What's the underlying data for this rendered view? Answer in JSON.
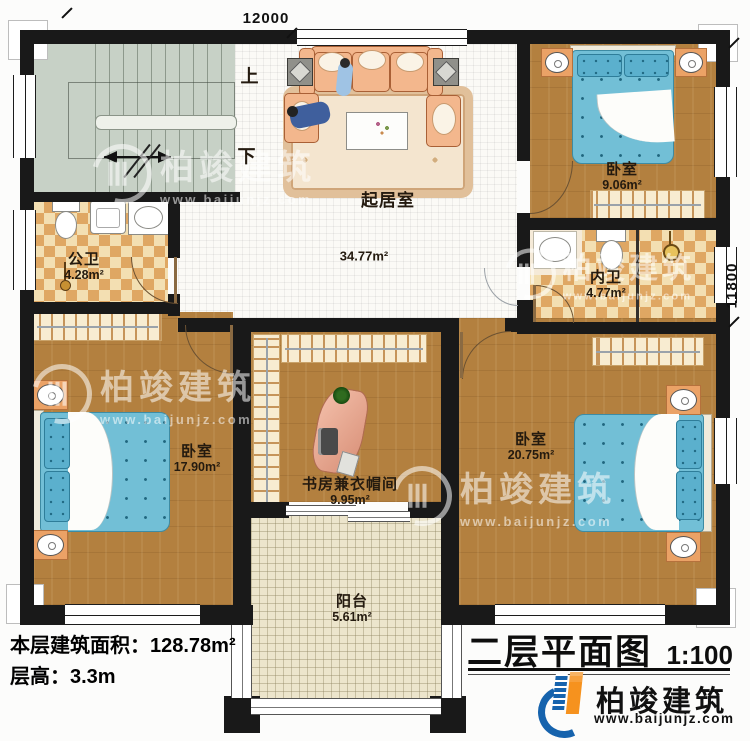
{
  "meta": {
    "dim_top": "12000",
    "dim_right": "11800"
  },
  "stairs": {
    "up": "上",
    "down": "下"
  },
  "rooms": {
    "living": {
      "name": "起居室",
      "area": "34.77m²"
    },
    "bedroom_tr": {
      "name": "卧室",
      "area": "9.06m²"
    },
    "bath_public": {
      "name": "公卫",
      "area": "4.28m²"
    },
    "bath_private": {
      "name": "内卫",
      "area": "4.77m²"
    },
    "bedroom_bl": {
      "name": "卧室",
      "area": "17.90m²"
    },
    "study": {
      "name": "书房兼衣帽间",
      "area": "9.95m²"
    },
    "bedroom_br": {
      "name": "卧室",
      "area": "20.75m²"
    },
    "balcony": {
      "name": "阳台",
      "area": "5.61m²"
    }
  },
  "info": {
    "area_label": "本层建筑面积：",
    "area_value": "128.78m²",
    "height_label": "层高：",
    "height_value": "3.3m"
  },
  "titleblock": {
    "title": "二层平面图",
    "scale": "1:100",
    "brand": "柏竣建筑",
    "website": "www.baijunjz.com"
  },
  "watermark": {
    "brand": "柏竣建筑",
    "website": "www.baijunjz.com"
  },
  "colors": {
    "accent_blue": "#1663ad",
    "accent_orange": "#f6921e",
    "wall": "#191919"
  }
}
